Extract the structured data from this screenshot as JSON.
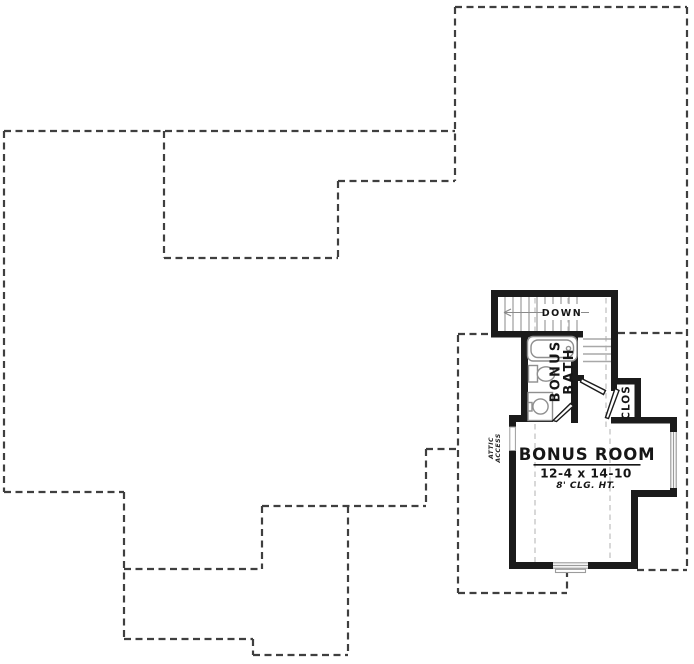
{
  "plan": {
    "room": {
      "title": "BONUS ROOM",
      "dimensions": "12-4 x 14-10",
      "ceiling_height": "8' CLG. HT."
    },
    "labels": {
      "down": "DOWN",
      "bath_line1": "BONUS",
      "bath_line2": "BATH",
      "closet": "CLOS.",
      "attic_line1": "ATTIC",
      "attic_line2": "ACCESS"
    },
    "colors": {
      "background": "#ffffff",
      "wall": "#1b1b1b",
      "roof_outline_dashed": "#3f3f3f",
      "ceiling_break_dashed": "#c3c3c3",
      "fixture_stroke": "#8f8f8f",
      "text": "#161616"
    }
  }
}
